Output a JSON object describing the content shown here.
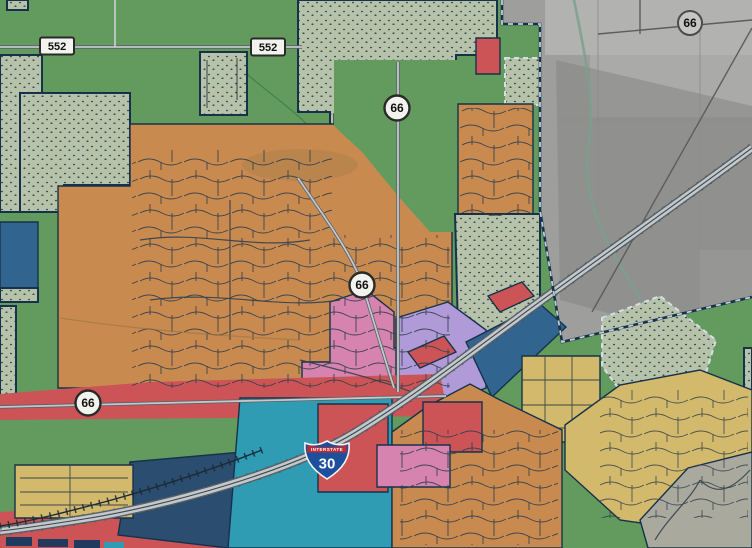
{
  "map": {
    "description": "Municipal zoning map overlaid on grayscale aerial imagery",
    "shields": {
      "state_552": {
        "label": "552"
      },
      "state_66": {
        "label": "66"
      },
      "interstate_30": {
        "banner": "INTERSTATE",
        "number": "30"
      }
    },
    "colors": {
      "zone_orange": "#c98a50",
      "zone_green": "#639b5f",
      "zone_teal": "#2f9cb4",
      "zone_red": "#cd5456",
      "zone_blue": "#31658f",
      "zone_navy": "#1e3a5f",
      "zone_navy2": "#2a4d70",
      "zone_pink": "#d683b0",
      "zone_purple": "#b09bd8",
      "zone_yellow": "#d3b96b",
      "stipple_fill": "#b7c2ab",
      "stipple_dot": "#31504a",
      "boundary_navy": "#16324a",
      "dash_light": "#d7dee3",
      "aerial_gray": "#9e9e9c",
      "aerial_light": "#b2b2b0",
      "aerial_dark": "#858583",
      "road_fill": "#c3c8cb",
      "road_casing": "#596066",
      "rail_dark": "#1b2a36",
      "creek_teal": "#7aa08e",
      "street_line": "#33404d",
      "shield_fill": "#f2f2ee",
      "interstate_blue": "#1d4f9c",
      "interstate_red": "#bf2b34"
    }
  }
}
